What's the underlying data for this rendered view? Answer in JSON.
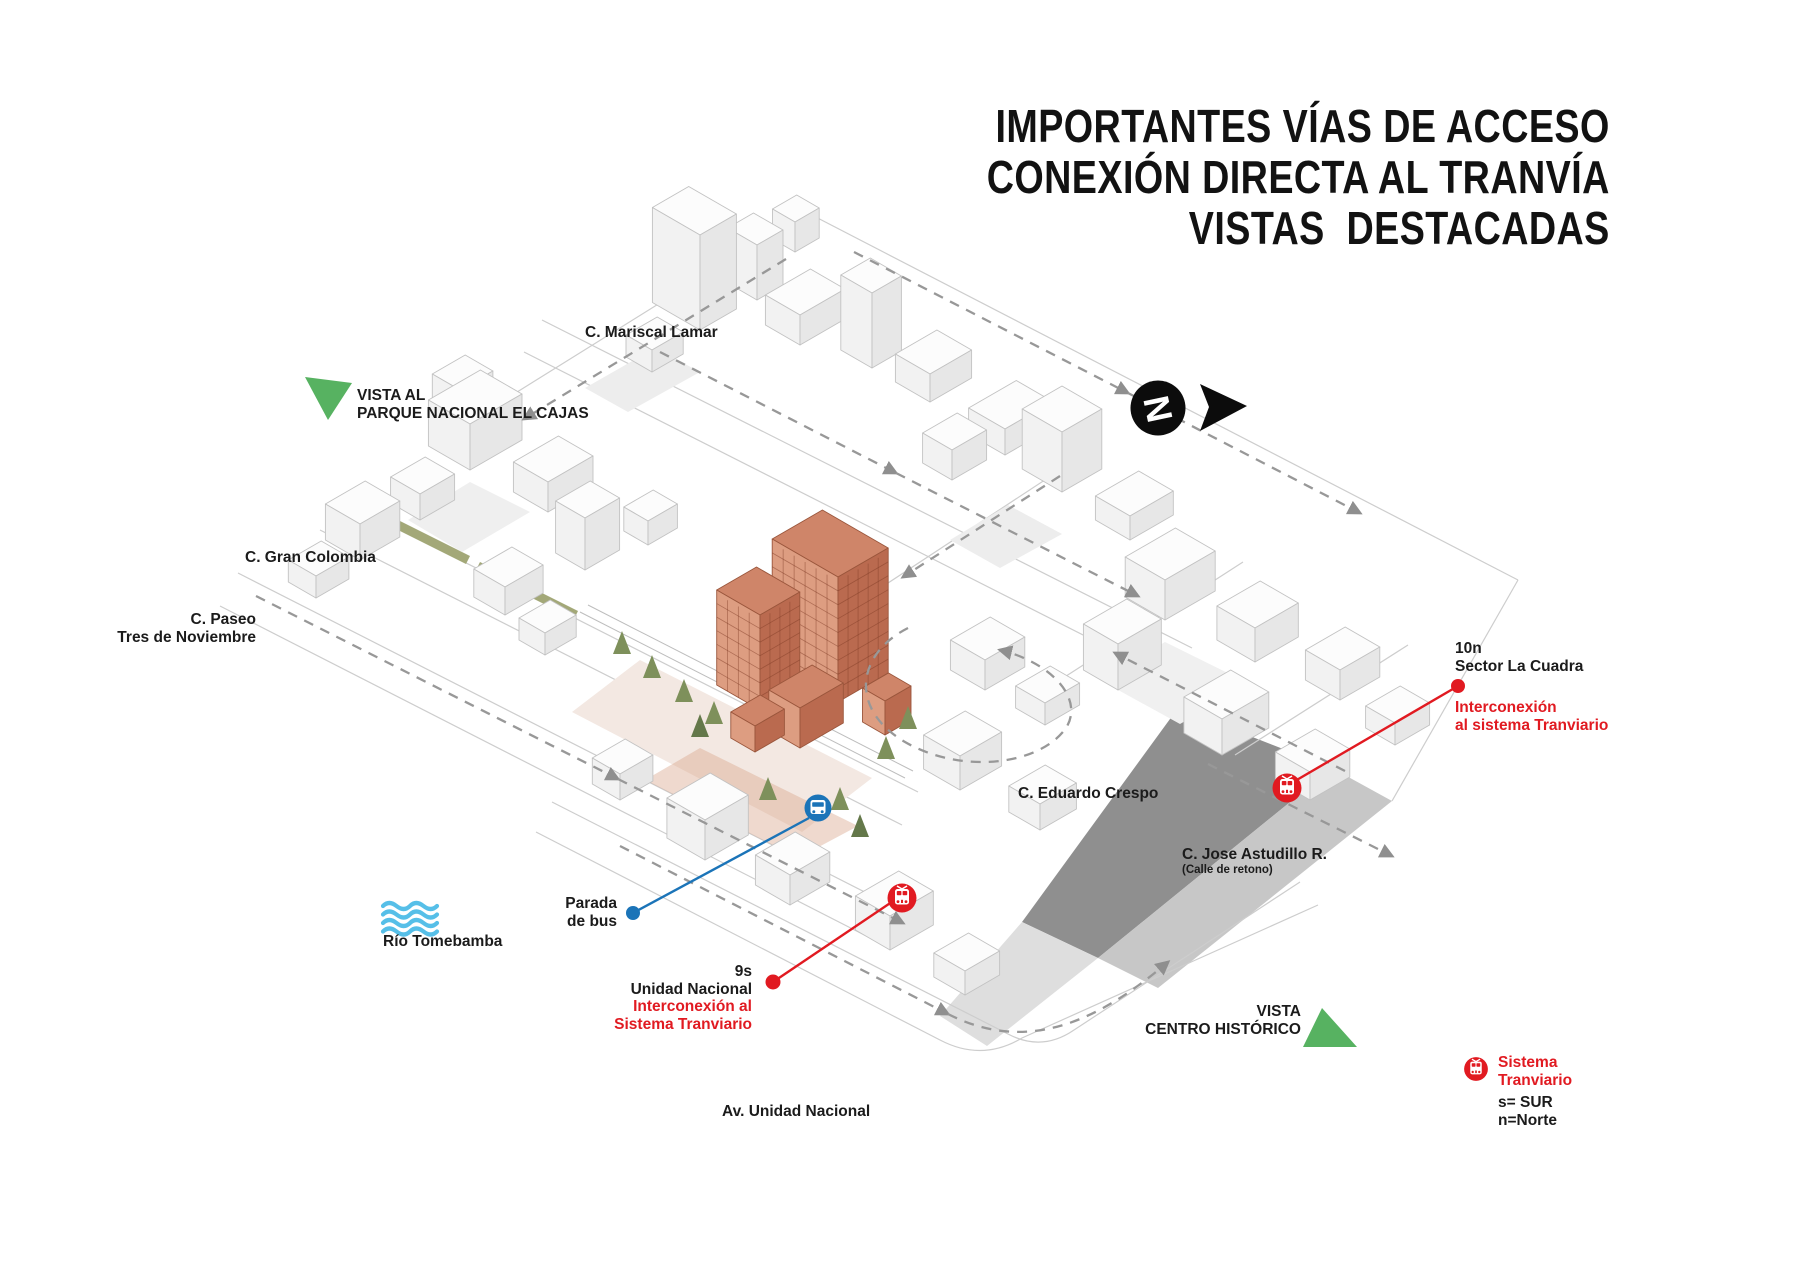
{
  "title": {
    "line1": "IMPORTANTES VÍAS DE ACCESO",
    "line2": "CONEXIÓN DIRECTA AL TRANVÍA",
    "line3": "VISTAS  DESTACADAS"
  },
  "north": {
    "letter": "N"
  },
  "streets": {
    "mariscal_lamar": "C. Mariscal Lamar",
    "gran_colombia": "C. Gran Colombia",
    "paseo_l1": "C. Paseo",
    "paseo_l2": "Tres de Noviembre",
    "eduardo_crespo": "C. Eduardo Crespo",
    "jose_astudillo": "C. Jose Astudillo R.",
    "jose_astudillo_note": "(Calle de retono)",
    "av_unidad_nacional": "Av. Unidad Nacional"
  },
  "views": {
    "cajas_l1": "VISTA AL",
    "cajas_l2": "PARQUE NACIONAL EL CAJAS",
    "centro_l1": "VISTA",
    "centro_l2": "CENTRO HISTÓRICO"
  },
  "river": {
    "name": "Río Tomebamba"
  },
  "bus_stop": {
    "l1": "Parada",
    "l2": "de bus"
  },
  "tram_la_cuadra": {
    "code": "10n",
    "name": "Sector La Cuadra",
    "note_l1": "Interconexión",
    "note_l2": "al sistema Tranviario"
  },
  "tram_unidad": {
    "code": "9s",
    "name": "Unidad Nacional",
    "note_l1": "Interconexión al",
    "note_l2": "Sistema Tranviario"
  },
  "legend": {
    "l1": "Sistema",
    "l2": "Tranviario",
    "sur": "s= SUR",
    "norte": "n=Norte"
  },
  "colors": {
    "accent_red": "#E11A21",
    "accent_blue": "#1B74B8",
    "accent_green": "#57B261",
    "water_blue": "#56BFE8",
    "median_olive": "#A3A878",
    "building_terracotta": "#C97F63",
    "ink": "#1B1B1B"
  }
}
